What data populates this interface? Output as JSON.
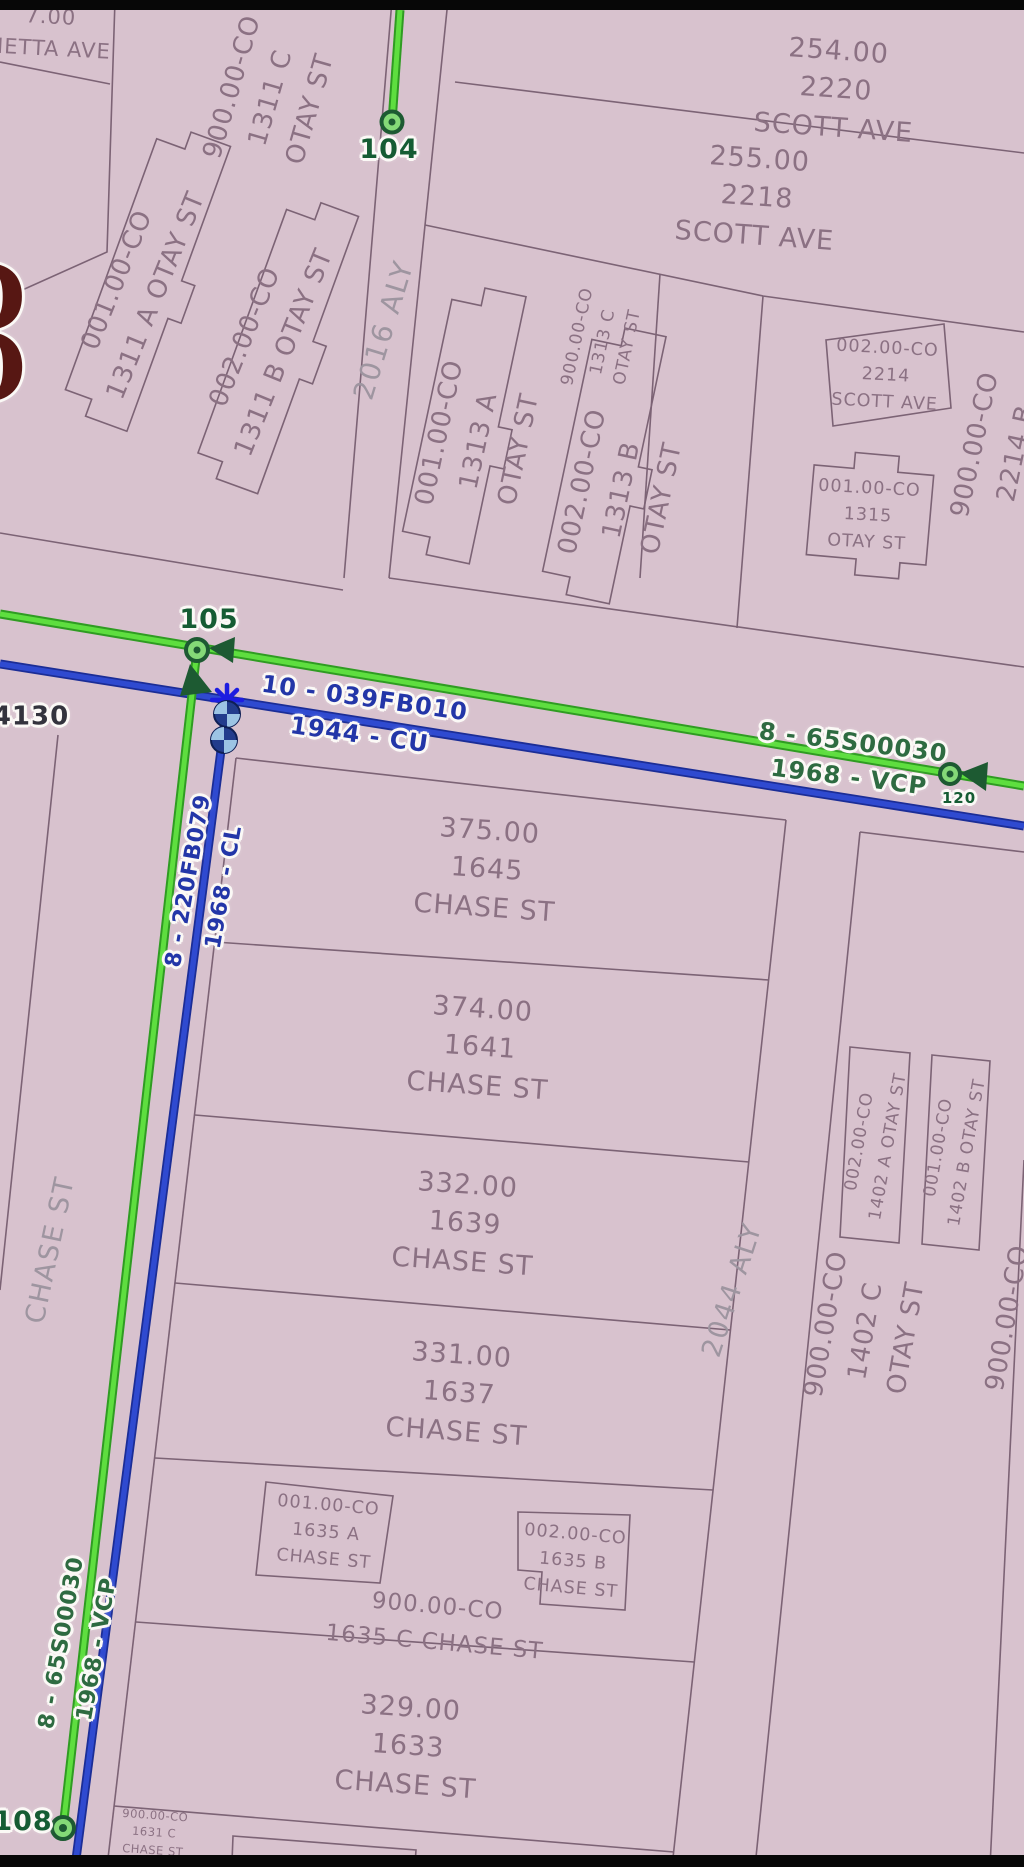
{
  "map": {
    "colors": {
      "parcel_fill": "#d8c2ce",
      "parcel_line": "#7c6375",
      "sewer_main_green": "#52d838",
      "storm_main_blue": "#2f4ad0",
      "node_label_green": "#155c33",
      "pipe_label_blue": "#2336a8",
      "watermark_red": "#571713"
    },
    "region_labels": [
      {
        "lines": [
          "7.00",
          "NETTA AVE"
        ]
      },
      {
        "lines": [
          "254.00",
          "2220",
          "SCOTT AVE"
        ]
      },
      {
        "lines": [
          "255.00",
          "2218",
          "SCOTT AVE"
        ]
      },
      {
        "lines": [
          "900.00-CO",
          "1311 C",
          "OTAY ST"
        ]
      },
      {
        "lines": [
          "001.00-CO",
          "1311 A OTAY ST"
        ]
      },
      {
        "lines": [
          "002.00-CO",
          "1311 B OTAY ST"
        ]
      },
      {
        "lines": [
          "900.00-CO",
          "1313 C",
          "OTAY ST"
        ]
      },
      {
        "lines": [
          "001.00-CO",
          "1313 A",
          "OTAY ST"
        ]
      },
      {
        "lines": [
          "002.00-CO",
          "1313 B",
          "OTAY ST"
        ]
      },
      {
        "lines": [
          "002.00-CO",
          "2214",
          "SCOTT AVE"
        ]
      },
      {
        "lines": [
          "001.00-CO",
          "1315",
          "OTAY ST"
        ]
      },
      {
        "lines": [
          "900.00-CO",
          "2214 B"
        ]
      },
      {
        "lines": [
          "375.00",
          "1645",
          "CHASE ST"
        ]
      },
      {
        "lines": [
          "374.00",
          "1641",
          "CHASE ST"
        ]
      },
      {
        "lines": [
          "332.00",
          "1639",
          "CHASE ST"
        ]
      },
      {
        "lines": [
          "331.00",
          "1637",
          "CHASE ST"
        ]
      },
      {
        "lines": [
          "001.00-CO",
          "1635 A",
          "CHASE ST"
        ]
      },
      {
        "lines": [
          "002.00-CO",
          "1635 B",
          "CHASE ST"
        ]
      },
      {
        "lines": [
          "900.00-CO",
          "1635 C CHASE ST"
        ]
      },
      {
        "lines": [
          "329.00",
          "1633",
          "CHASE ST"
        ]
      },
      {
        "lines": [
          "900.00-CO",
          "1631 C",
          "CHASE ST"
        ]
      },
      {
        "lines": [
          "002.00-CO",
          "1402 A OTAY ST"
        ]
      },
      {
        "lines": [
          "001.00-CO",
          "1402 B OTAY ST"
        ]
      },
      {
        "lines": [
          "900.00-CO",
          "1402 C",
          "OTAY ST"
        ]
      },
      {
        "lines": [
          "900.00-CO"
        ]
      }
    ],
    "street_labels": [
      "2016 ALY",
      "2044 ALY",
      "CHASE ST"
    ],
    "node_labels": [
      "104",
      "105",
      "108",
      "120"
    ],
    "pipe_labels": [
      {
        "line1": "10 - 039FB010",
        "line2": "1944 - CU"
      },
      {
        "line1": "8 - 65S00030",
        "line2": "1968 - VCP"
      },
      {
        "line1": "8 - 220FB079",
        "line2": "1968 - CL"
      },
      {
        "line1": "8 - 65S00030",
        "line2": "1968 - VCP"
      }
    ],
    "misc_labels": {
      "street_number": "4130"
    },
    "watermark": {
      "letters": [
        "D",
        "O"
      ]
    }
  }
}
